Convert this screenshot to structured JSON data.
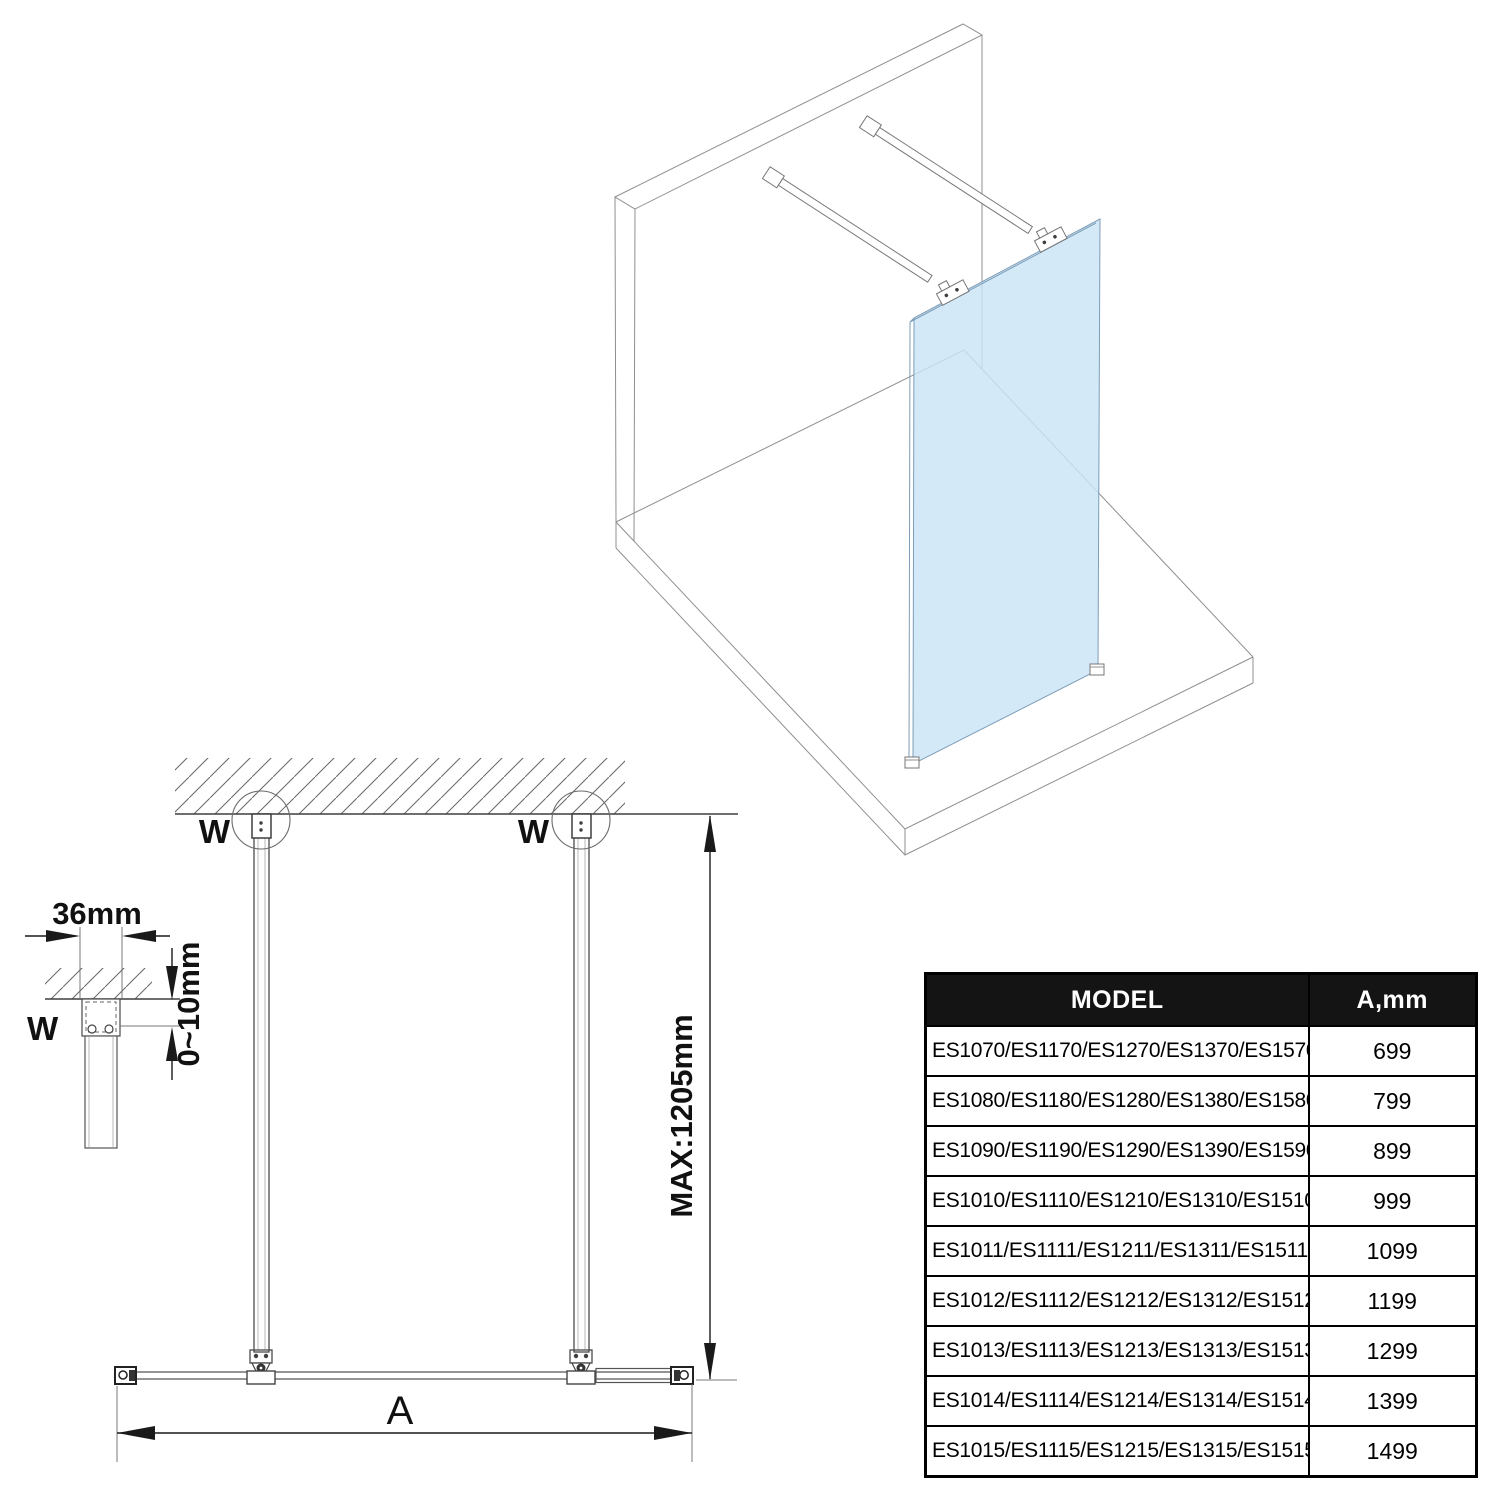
{
  "colors": {
    "glass_blue": "#cae4f7",
    "outline_gray_3d": "#8f8f8f",
    "line_dark_2d": "#3f3f3f",
    "dimension_black": "#1a1a1a",
    "table_header_bg": "#141414",
    "table_header_text": "#ffffff"
  },
  "plan_view": {
    "w_left": "W",
    "w_right": "W",
    "max_depth": "MAX:1205mm",
    "width_label": "A"
  },
  "detail_view": {
    "bracket_width": "36mm",
    "adjustment_range": "0~10mm",
    "wall_label": "W"
  },
  "table": {
    "headers": {
      "model": "MODEL",
      "a_mm": "A,mm"
    },
    "rows": [
      {
        "model": "ES1070/ES1170/ES1270/ES1370/ES1570",
        "a_mm": "699"
      },
      {
        "model": "ES1080/ES1180/ES1280/ES1380/ES1580",
        "a_mm": "799"
      },
      {
        "model": "ES1090/ES1190/ES1290/ES1390/ES1590",
        "a_mm": "899"
      },
      {
        "model": "ES1010/ES1110/ES1210/ES1310/ES1510",
        "a_mm": "999"
      },
      {
        "model": "ES1011/ES1111/ES1211/ES1311/ES1511",
        "a_mm": "1099"
      },
      {
        "model": "ES1012/ES1112/ES1212/ES1312/ES1512",
        "a_mm": "1199"
      },
      {
        "model": "ES1013/ES1113/ES1213/ES1313/ES1513",
        "a_mm": "1299"
      },
      {
        "model": "ES1014/ES1114/ES1214/ES1314/ES1514",
        "a_mm": "1399"
      },
      {
        "model": "ES1015/ES1115/ES1215/ES1315/ES1515",
        "a_mm": "1499"
      }
    ]
  }
}
